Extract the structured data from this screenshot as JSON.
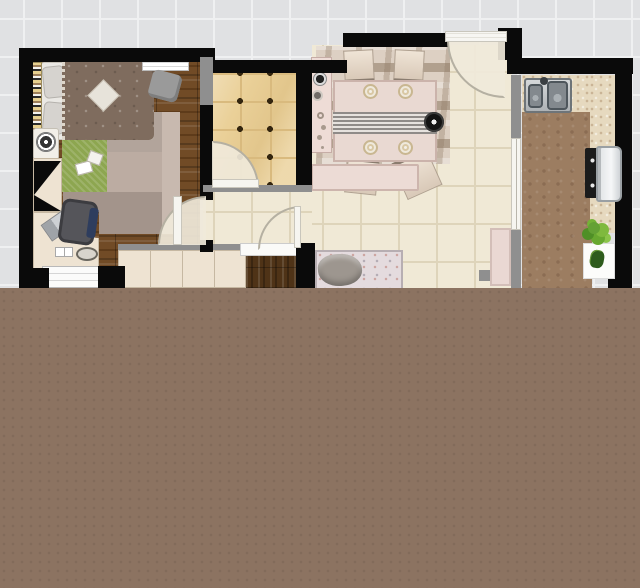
{
  "meta": {
    "view": "apartment-floor-plan-top-view",
    "canvas_width": 640,
    "canvas_height": 588
  },
  "palette": {
    "bg": "#e0e1e3",
    "grid_line": "#eff0f1",
    "wall": "#0a0a0a",
    "half_wall": "#8f8f8f",
    "brown_area": "#8c7361",
    "wood": "#714b26",
    "wood_light": "#8a5f33",
    "wood_dark": "#4f3317",
    "cream_floor": "#f0e9d6",
    "cream_line": "#ded4ba",
    "gold_tile": "#ead098",
    "gold_line": "#d9ba7e",
    "tile_dot": "#33250f",
    "cabinet": "#eee3d2",
    "cabinet_line": "#c6b8a2",
    "sheet": "#eae8e4",
    "duvet": "#7f6c5e",
    "pillow": "#d6d3cf",
    "green_rug": "#8da650",
    "rug_a": "#b2a49b",
    "rug_b": "#bcaca2",
    "rug_c": "#a3948b",
    "rug_d": "#c8b9af",
    "bookshelf": "#e6cf8f",
    "chair_dark": "#55555a",
    "chair_pillow": "#2e3d5e",
    "dining_rug": "#ddd0c3",
    "rug_wave": "#8f7b65",
    "table": "#e9d9d2",
    "table_edge": "#cbb3ab",
    "runner_dark": "#8f8b88",
    "sofa": "#e4dbde",
    "throw": "#9d968f",
    "counter": "#e6d9bf",
    "kitchen_floor": "#9c7d61",
    "steel": "#b6babd",
    "steel_dark": "#4e565c",
    "appliance": "#ebedee",
    "cooktop": "#1b1b1b",
    "plant": "#64a135",
    "plant_dark": "#3f7a1f",
    "door": "#f6f5f0",
    "door_edge": "#c9c6bc",
    "arc": "#b5b0a2",
    "white_unit": "#fbfbfa",
    "pink_panel": "#ead8d3"
  },
  "scene": {
    "regions": [
      "background-grid",
      "bedroom",
      "entry",
      "hallway",
      "living-dining-room",
      "kitchen",
      "lower-blank-area"
    ],
    "bedroom_items": [
      "double-bed",
      "pillows",
      "duvet",
      "diamond-cushion",
      "bookshelf",
      "table-fan",
      "open-wardrobe",
      "corner-desk",
      "laptop",
      "office-chair",
      "drawer-unit",
      "green-rug",
      "area-rugs",
      "wall-shelf",
      "lounge-chair",
      "magazines",
      "bottom-cabinet-row"
    ],
    "entry_items": [
      "gold-floor-tiles",
      "interior-door"
    ],
    "living_dining_items": [
      "area-rug",
      "dining-table",
      "table-runner",
      "dinner-plates",
      "rosette-centerpiece",
      "dining-chairs",
      "sideboard",
      "decor-plates",
      "low-cabinet",
      "sofa",
      "throw-blanket",
      "entry-door",
      "hall-door",
      "pink-panel"
    ],
    "kitchen_items": [
      "double-basin-sink",
      "sink-countertop",
      "side-countertop",
      "cooktop",
      "oven",
      "potted-plant",
      "sliding-door"
    ],
    "counts": {
      "dining_chairs": 4,
      "dinner_plates": 4,
      "door_swings": 4,
      "sliding_doors": 1
    }
  }
}
